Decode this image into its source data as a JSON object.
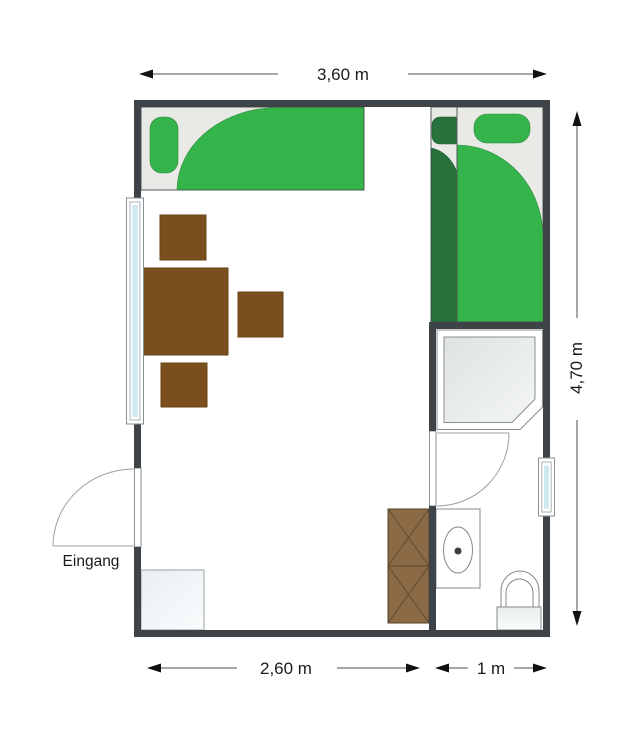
{
  "title": "Zimmergrundriss",
  "labels": {
    "width_top": "3,60 m",
    "height_right": "4,70 m",
    "width_bottom_main": "2,60 m",
    "width_bottom_bath": "1 m",
    "entrance": "Eingang"
  },
  "dimensions": {
    "total_width_m": 3.6,
    "total_height_m": 4.7,
    "main_room_width_m": 2.6,
    "bath_width_m": 1.0
  },
  "colors": {
    "wall": "#3e4347",
    "bed_cover_green": "#35b44b",
    "bed_cover_dark_green": "#26713c",
    "bed_base": "#e9e9e6",
    "table_brown": "#7a4e1d",
    "cabinet_brown": "#8b6b45",
    "window_glass": "#cfe9f1",
    "background": "#ffffff",
    "dimension_text": "#1a1a1a"
  }
}
